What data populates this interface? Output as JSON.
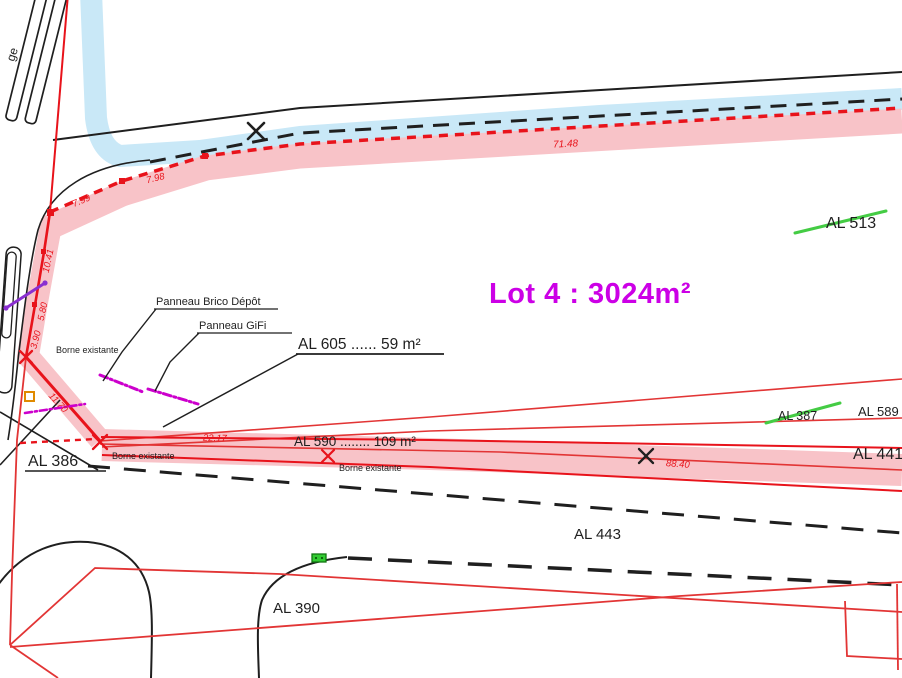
{
  "plan": {
    "lot_label": "Lot 4 : 3024m²",
    "street_fragment": "ge",
    "parcels": {
      "al513": "AL 513",
      "al605": "AL 605 ...... 59 m²",
      "al590": "AL 590 ........ 109 m²",
      "al386": "AL 386",
      "al387": "AL 387",
      "al589": "AL 589",
      "al441": "AL 441",
      "al443": "AL 443",
      "al390": "AL 390"
    },
    "annotations": {
      "panneau_brico": "Panneau  Brico Dépôt",
      "panneau_gifi": "Panneau  GiFi",
      "borne_existante": "Borne existante"
    },
    "measurements": {
      "m7148": "71.48",
      "m799": "7.99",
      "m798": "7.98",
      "m1041": "10.41",
      "m580": "5.80",
      "m390": "3.90",
      "m1170": "11.70",
      "m2217": "22.17",
      "m8840": "88.40"
    },
    "colors": {
      "boundary_red": "#e8131b",
      "thin_red": "#e23535",
      "pink_band": "#f8c3c8",
      "stream_blue": "#c9e8f7",
      "lot_magenta": "#cc00e6",
      "struck_green": "#44cc44",
      "panneau_magenta": "#cc00cc",
      "servitude_purple": "#8a2fd0",
      "symbol_orange": "#e08a00",
      "marker_green": "#33cc33"
    }
  }
}
